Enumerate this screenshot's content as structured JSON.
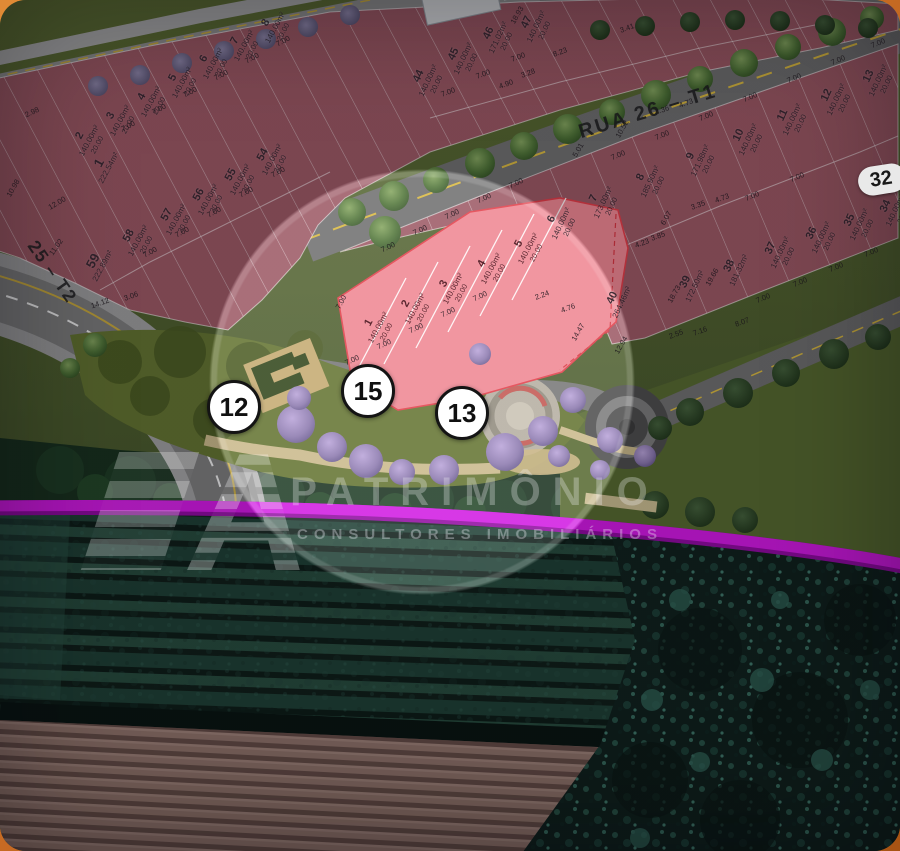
{
  "colors": {
    "lot_red": "#9b5763",
    "highlight_pink": "#ef8591",
    "magenta_boundary": "#d118e2",
    "road_gray": "#6e6e6e",
    "background_orange": "#c96c24"
  },
  "streets": {
    "rua26": "RUA 26 – T1",
    "rua25": "25 – T2"
  },
  "block_badge": "32",
  "watermark": {
    "logo_letter": "A",
    "brand": "PATRIMÔNIO",
    "tagline": "CONSULTORES IMOBILIÁRIOS"
  },
  "markers": [
    {
      "label": "12",
      "x": 234,
      "y": 407
    },
    {
      "label": "15",
      "x": 368,
      "y": 391
    },
    {
      "label": "13",
      "x": 462,
      "y": 413
    }
  ],
  "lot_labels": [
    {
      "n": "1",
      "area": "222.54m²",
      "depth": "",
      "x": 103,
      "y": 165,
      "rot": -62,
      "cls": "lg"
    },
    {
      "n": "2",
      "area": "140.00m²",
      "depth": "20.00",
      "x": 88,
      "y": 140,
      "rot": -62,
      "cls": ""
    },
    {
      "n": "3",
      "area": "140.00m²",
      "depth": "20.00",
      "x": 119,
      "y": 120,
      "rot": -62,
      "cls": ""
    },
    {
      "n": "4",
      "area": "140.00m²",
      "depth": "20.00",
      "x": 150,
      "y": 101,
      "rot": -62,
      "cls": ""
    },
    {
      "n": "5",
      "area": "140.00m²",
      "depth": "20.00",
      "x": 181,
      "y": 82,
      "rot": -62,
      "cls": ""
    },
    {
      "n": "6",
      "area": "140.00m²",
      "depth": "20.00",
      "x": 212,
      "y": 63,
      "rot": -62,
      "cls": ""
    },
    {
      "n": "7",
      "area": "140.00m²",
      "depth": "20.00",
      "x": 243,
      "y": 45,
      "rot": -62,
      "cls": ""
    },
    {
      "n": "8",
      "area": "140.00m²",
      "depth": "20.00",
      "x": 274,
      "y": 27,
      "rot": -62,
      "cls": ""
    },
    {
      "n": "59",
      "area": "222.89m²",
      "depth": "",
      "x": 97,
      "y": 263,
      "rot": -62,
      "cls": "lg"
    },
    {
      "n": "58",
      "area": "140.00m²",
      "depth": "20.00",
      "x": 137,
      "y": 240,
      "rot": -62,
      "cls": ""
    },
    {
      "n": "57",
      "area": "140.00m²",
      "depth": "20.00",
      "x": 175,
      "y": 219,
      "rot": -62,
      "cls": ""
    },
    {
      "n": "56",
      "area": "140.00m²",
      "depth": "20.00",
      "x": 207,
      "y": 199,
      "rot": -62,
      "cls": ""
    },
    {
      "n": "55",
      "area": "140.00m²",
      "depth": "20.00",
      "x": 239,
      "y": 179,
      "rot": -62,
      "cls": ""
    },
    {
      "n": "54",
      "area": "140.00m²",
      "depth": "20.00",
      "x": 271,
      "y": 159,
      "rot": -62,
      "cls": ""
    },
    {
      "n": "44",
      "area": "140.00m²",
      "depth": "20.00",
      "x": 427,
      "y": 80,
      "rot": -65,
      "cls": ""
    },
    {
      "n": "45",
      "area": "140.00m²",
      "depth": "20.00",
      "x": 462,
      "y": 58,
      "rot": -65,
      "cls": ""
    },
    {
      "n": "46",
      "area": "171.02m²",
      "depth": "20.00",
      "x": 497,
      "y": 37,
      "rot": -65,
      "cls": ""
    },
    {
      "n": "47",
      "area": "140.00m²",
      "depth": "20.00",
      "x": 535,
      "y": 26,
      "rot": -65,
      "cls": ""
    },
    {
      "n": "6",
      "area": "140.00m²",
      "depth": "20.00",
      "x": 560,
      "y": 223,
      "rot": -65,
      "cls": ""
    },
    {
      "n": "7",
      "area": "173.00m²",
      "depth": "20.00",
      "x": 602,
      "y": 202,
      "rot": -65,
      "cls": ""
    },
    {
      "n": "8",
      "area": "185.90m²",
      "depth": "20.00",
      "x": 649,
      "y": 181,
      "rot": -65,
      "cls": ""
    },
    {
      "n": "9",
      "area": "171.98m²",
      "depth": "20.00",
      "x": 699,
      "y": 160,
      "rot": -65,
      "cls": ""
    },
    {
      "n": "10",
      "area": "140.00m²",
      "depth": "20.00",
      "x": 747,
      "y": 139,
      "rot": -65,
      "cls": ""
    },
    {
      "n": "11",
      "area": "140.00m²",
      "depth": "20.00",
      "x": 791,
      "y": 119,
      "rot": -65,
      "cls": ""
    },
    {
      "n": "12",
      "area": "140.00m²",
      "depth": "20.00",
      "x": 835,
      "y": 99,
      "rot": -65,
      "cls": ""
    },
    {
      "n": "13",
      "area": "140.00m²",
      "depth": "20.00",
      "x": 877,
      "y": 80,
      "rot": -65,
      "cls": ""
    },
    {
      "n": "40",
      "area": "264.46m²",
      "depth": "",
      "x": 617,
      "y": 300,
      "rot": -65,
      "cls": ""
    },
    {
      "n": "39",
      "area": "172.50m²",
      "depth": "",
      "x": 690,
      "y": 284,
      "rot": -65,
      "cls": ""
    },
    {
      "n": "38",
      "area": "181.32m²",
      "depth": "",
      "x": 734,
      "y": 268,
      "rot": -65,
      "cls": ""
    },
    {
      "n": "37",
      "area": "140.00m²",
      "depth": "20.00",
      "x": 779,
      "y": 252,
      "rot": -65,
      "cls": ""
    },
    {
      "n": "36",
      "area": "140.00m²",
      "depth": "20.00",
      "x": 820,
      "y": 237,
      "rot": -65,
      "cls": ""
    },
    {
      "n": "35",
      "area": "140.00m²",
      "depth": "20.00",
      "x": 858,
      "y": 224,
      "rot": -65,
      "cls": ""
    },
    {
      "n": "34",
      "area": "140.00m²",
      "depth": "20.00",
      "x": 894,
      "y": 210,
      "rot": -65,
      "cls": ""
    },
    {
      "n": "1",
      "area": "140.00m²",
      "depth": "20.00",
      "x": 377,
      "y": 327,
      "rot": -62,
      "cls": "hl"
    },
    {
      "n": "2",
      "area": "140.00m²",
      "depth": "20.00",
      "x": 414,
      "y": 308,
      "rot": -62,
      "cls": "hl"
    },
    {
      "n": "3",
      "area": "140.00m²",
      "depth": "20.00",
      "x": 452,
      "y": 288,
      "rot": -62,
      "cls": "hl"
    },
    {
      "n": "4",
      "area": "140.00m²",
      "depth": "20.00",
      "x": 490,
      "y": 268,
      "rot": -62,
      "cls": "hl"
    },
    {
      "n": "5",
      "area": "140.00m²",
      "depth": "20.00",
      "x": 527,
      "y": 248,
      "rot": -62,
      "cls": "hl"
    }
  ],
  "dims": [
    {
      "t": "7.00",
      "x": 128,
      "y": 126,
      "rot": -28
    },
    {
      "t": "7.00",
      "x": 159,
      "y": 109,
      "rot": -28
    },
    {
      "t": "7.00",
      "x": 190,
      "y": 92,
      "rot": -28
    },
    {
      "t": "7.00",
      "x": 221,
      "y": 75,
      "rot": -28
    },
    {
      "t": "7.00",
      "x": 252,
      "y": 58,
      "rot": -28
    },
    {
      "t": "7.00",
      "x": 283,
      "y": 41,
      "rot": -28
    },
    {
      "t": "7.00",
      "x": 150,
      "y": 252,
      "rot": -28
    },
    {
      "t": "7.00",
      "x": 182,
      "y": 232,
      "rot": -28
    },
    {
      "t": "7.00",
      "x": 214,
      "y": 212,
      "rot": -28
    },
    {
      "t": "7.00",
      "x": 246,
      "y": 192,
      "rot": -28
    },
    {
      "t": "7.00",
      "x": 278,
      "y": 172,
      "rot": -28
    },
    {
      "t": "7.00",
      "x": 448,
      "y": 92,
      "rot": -20
    },
    {
      "t": "7.00",
      "x": 483,
      "y": 74,
      "rot": -20
    },
    {
      "t": "7.00",
      "x": 518,
      "y": 57,
      "rot": -20
    },
    {
      "t": "7.00",
      "x": 618,
      "y": 155,
      "rot": -23
    },
    {
      "t": "7.00",
      "x": 662,
      "y": 135,
      "rot": -23
    },
    {
      "t": "7.00",
      "x": 706,
      "y": 116,
      "rot": -23
    },
    {
      "t": "7.00",
      "x": 750,
      "y": 97,
      "rot": -23
    },
    {
      "t": "7.00",
      "x": 794,
      "y": 78,
      "rot": -23
    },
    {
      "t": "7.00",
      "x": 838,
      "y": 60,
      "rot": -23
    },
    {
      "t": "7.00",
      "x": 878,
      "y": 43,
      "rot": -23
    },
    {
      "t": "7.00",
      "x": 763,
      "y": 298,
      "rot": -23
    },
    {
      "t": "7.00",
      "x": 800,
      "y": 282,
      "rot": -23
    },
    {
      "t": "7.00",
      "x": 836,
      "y": 267,
      "rot": -23
    },
    {
      "t": "7.00",
      "x": 871,
      "y": 252,
      "rot": -23
    },
    {
      "t": "7.00",
      "x": 752,
      "y": 196,
      "rot": -23
    },
    {
      "t": "7.00",
      "x": 797,
      "y": 177,
      "rot": -23
    },
    {
      "t": "7.00",
      "x": 388,
      "y": 247,
      "rot": -25
    },
    {
      "t": "7.00",
      "x": 420,
      "y": 230,
      "rot": -25
    },
    {
      "t": "7.00",
      "x": 452,
      "y": 214,
      "rot": -25
    },
    {
      "t": "7.00",
      "x": 484,
      "y": 198,
      "rot": -25
    },
    {
      "t": "7.00",
      "x": 516,
      "y": 183,
      "rot": -25
    },
    {
      "t": "7.00",
      "x": 352,
      "y": 360,
      "rot": -25
    },
    {
      "t": "7.00",
      "x": 384,
      "y": 344,
      "rot": -25
    },
    {
      "t": "7.00",
      "x": 416,
      "y": 328,
      "rot": -25
    },
    {
      "t": "7.00",
      "x": 448,
      "y": 312,
      "rot": -25
    },
    {
      "t": "7.00",
      "x": 480,
      "y": 296,
      "rot": -25
    },
    {
      "t": "7.00",
      "x": 341,
      "y": 302,
      "rot": -62
    },
    {
      "t": "2.98",
      "x": 32,
      "y": 112,
      "rot": -25
    },
    {
      "t": "12.00",
      "x": 57,
      "y": 203,
      "rot": -30
    },
    {
      "t": "11.02",
      "x": 56,
      "y": 247,
      "rot": -55
    },
    {
      "t": "14.12",
      "x": 100,
      "y": 303,
      "rot": -20
    },
    {
      "t": "3.06",
      "x": 131,
      "y": 296,
      "rot": -20
    },
    {
      "t": "10.98",
      "x": 13,
      "y": 188,
      "rot": -60
    },
    {
      "t": "10.52",
      "x": 622,
      "y": 129,
      "rot": -60
    },
    {
      "t": "8.23",
      "x": 560,
      "y": 52,
      "rot": -20
    },
    {
      "t": "3.28",
      "x": 528,
      "y": 73,
      "rot": -20
    },
    {
      "t": "4.90",
      "x": 506,
      "y": 84,
      "rot": -20
    },
    {
      "t": "3.41",
      "x": 627,
      "y": 28,
      "rot": -20
    },
    {
      "t": "18.93",
      "x": 517,
      "y": 15,
      "rot": -60
    },
    {
      "t": "4.36",
      "x": 662,
      "y": 110,
      "rot": -20
    },
    {
      "t": "4.73",
      "x": 686,
      "y": 103,
      "rot": -20
    },
    {
      "t": "5.01",
      "x": 578,
      "y": 150,
      "rot": -60
    },
    {
      "t": "3.35",
      "x": 698,
      "y": 205,
      "rot": -20
    },
    {
      "t": "4.73",
      "x": 722,
      "y": 198,
      "rot": -20
    },
    {
      "t": "4.23",
      "x": 642,
      "y": 243,
      "rot": -20
    },
    {
      "t": "3.85",
      "x": 658,
      "y": 236,
      "rot": -20
    },
    {
      "t": "6.07",
      "x": 666,
      "y": 218,
      "rot": -60
    },
    {
      "t": "18.73",
      "x": 674,
      "y": 294,
      "rot": -60
    },
    {
      "t": "19.66",
      "x": 712,
      "y": 277,
      "rot": -60
    },
    {
      "t": "8.07",
      "x": 742,
      "y": 322,
      "rot": -20
    },
    {
      "t": "7.16",
      "x": 700,
      "y": 331,
      "rot": -20
    },
    {
      "t": "2.55",
      "x": 676,
      "y": 334,
      "rot": -20
    },
    {
      "t": "2.24",
      "x": 542,
      "y": 295,
      "rot": -20
    },
    {
      "t": "4.76",
      "x": 568,
      "y": 308,
      "rot": -20
    },
    {
      "t": "14.47",
      "x": 578,
      "y": 332,
      "rot": -60
    },
    {
      "t": "12.94",
      "x": 621,
      "y": 345,
      "rot": -60
    }
  ]
}
